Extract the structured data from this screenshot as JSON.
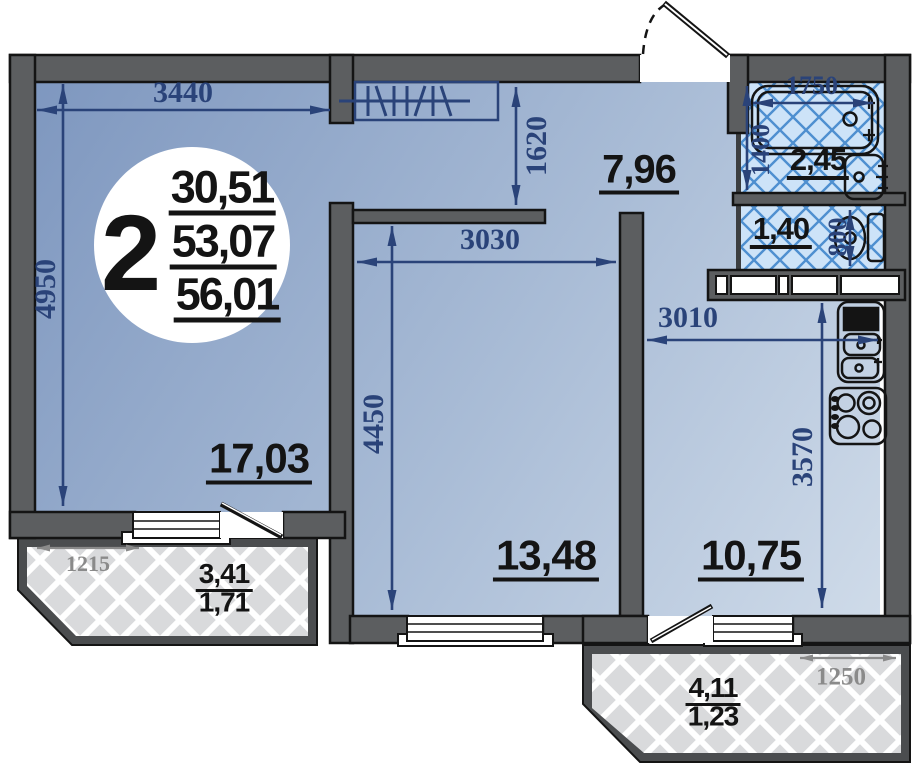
{
  "title": "2-room apartment floor plan",
  "unit_badge": {
    "rooms_count": "2",
    "living_area": "30,51",
    "area_no_balcony": "53,07",
    "total_area": "56,01"
  },
  "areas": {
    "living": "17,03",
    "bedroom": "13,48",
    "kitchen": "10,75",
    "hall": "7,96",
    "bathroom": "2,45",
    "wc": "1,40"
  },
  "balconies": {
    "left": {
      "area_full": "3,41",
      "area_reduced": "1,71",
      "dim": "1215"
    },
    "right": {
      "area_full": "4,11",
      "area_reduced": "1,23",
      "dim": "1250"
    }
  },
  "dims": {
    "living_w": "3440",
    "living_h": "4950",
    "hall_depth": "1620",
    "bedroom_w": "3030",
    "bedroom_h": "4450",
    "kitchen_w": "3010",
    "kitchen_h": "3570",
    "bath_w": "1750",
    "bath_h": "1400",
    "wc_w": "800"
  },
  "colors": {
    "wall": "#5c5e60",
    "wall2": "#4b4d4f",
    "ink": "#141414",
    "dim": "#2a4379",
    "tile_bg": "#cde3f8",
    "tile_line": "#4e8fd0",
    "balc_bg": "#d9dadc",
    "grad1": "#7e97bf",
    "grad2": "#c9d6e7",
    "gray": "#8a8a8a"
  }
}
